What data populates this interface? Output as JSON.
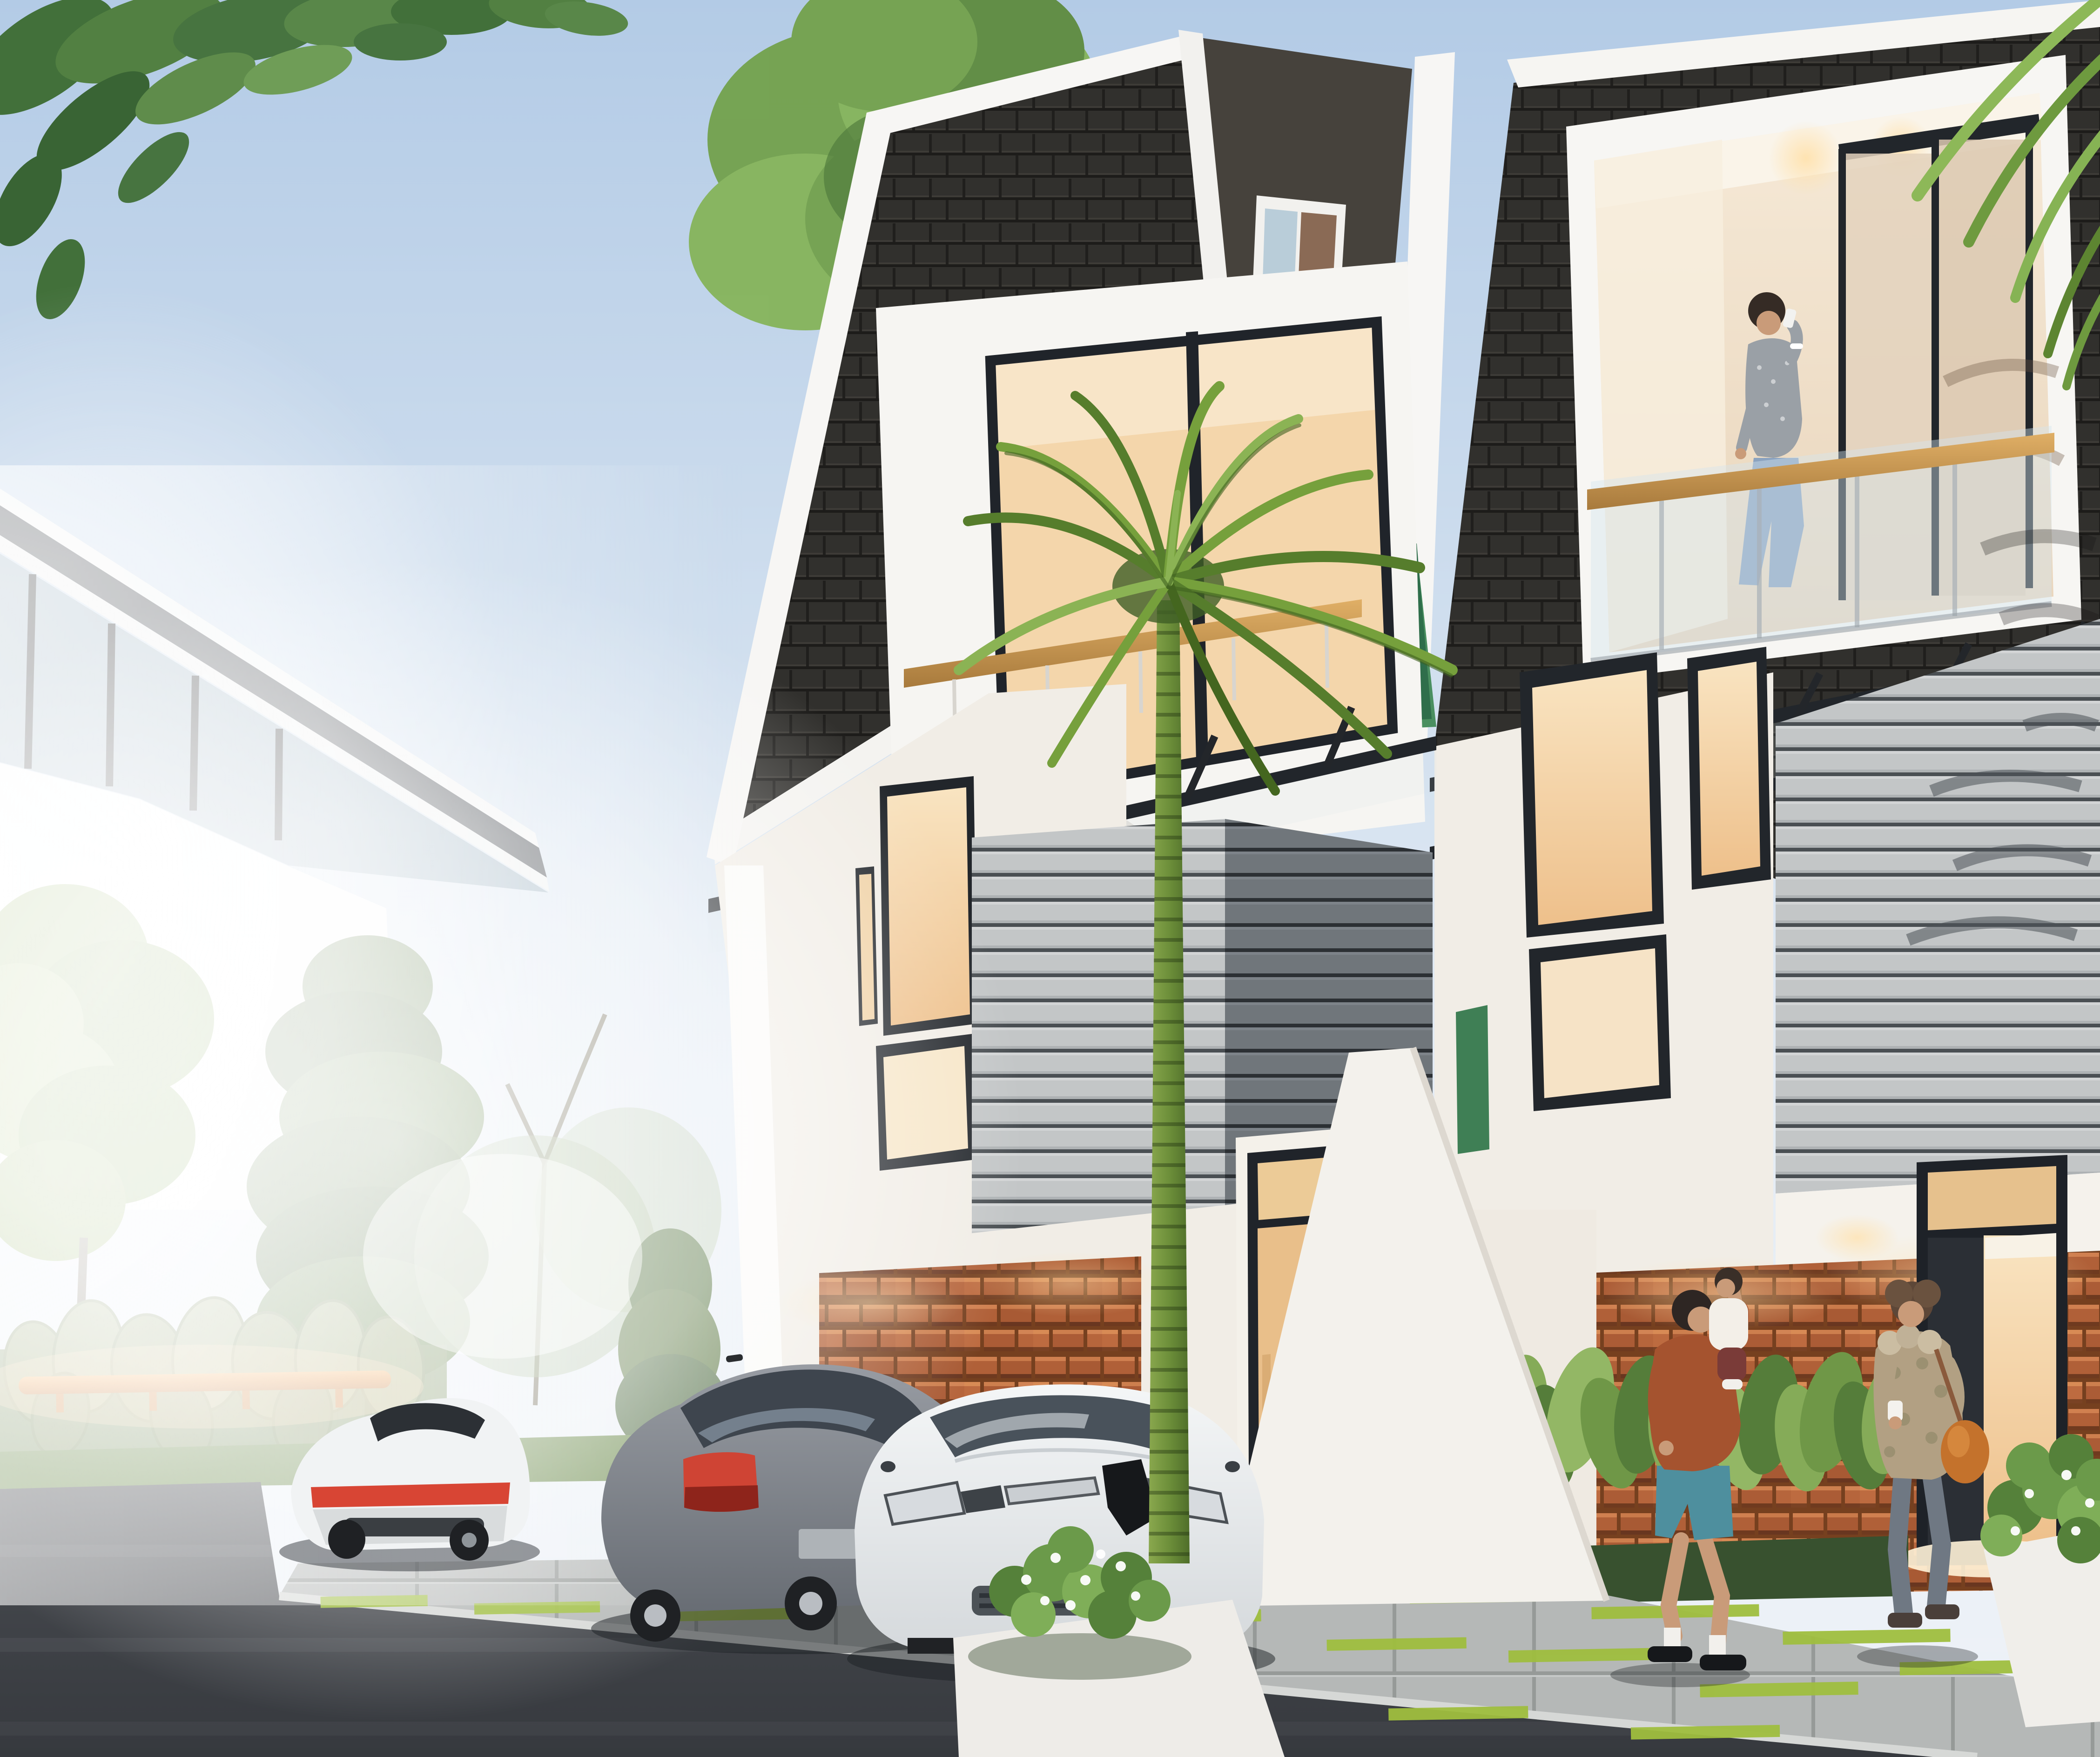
{
  "scene": {
    "description": "Dusk architectural rendering of two modern three-storey townhouses with black shingle roofs, white walls, a green accent wall and terracotta feature brick; warm lit windows, a tall slender palm in front, three cars parked on the paver drive, a woman on the upper balcony talking on a phone, a man carrying a child and a woman with a coffee cup and orange shoulder bag walking on the sidewalk, leafy trees, a white neighbouring house at left, hedge with an orange fence rail, pale blue sky with two birds",
    "objects": [
      {
        "name": "sky",
        "label": "pale blue dusk sky"
      },
      {
        "name": "birds",
        "label": "two birds flying"
      },
      {
        "name": "overhanging-branch",
        "label": "tree branch in top-left corner"
      },
      {
        "name": "neighbor-house",
        "label": "white neighbouring house with sloped dark fascia and clerestory windows"
      },
      {
        "name": "trees",
        "label": "deciduous tree, conifer and bare trees at left"
      },
      {
        "name": "hedge-orange-fence",
        "label": "agave hedge with orange fence rail"
      },
      {
        "name": "left-townhouse",
        "label": "left townhouse with shingle roof, white window box, wood rail, glass canopy, grey slat box, brick base, glass stair door"
      },
      {
        "name": "right-townhouse",
        "label": "right townhouse with roof balcony, glass railing, glass canopy, grey slat box, brick base, entry door"
      },
      {
        "name": "green-accent-wall",
        "label": "green feature wall between houses"
      },
      {
        "name": "palm-tree",
        "label": "tall slender palm in front of drive"
      },
      {
        "name": "white-coupe",
        "label": "white coupe parked at left, rear view"
      },
      {
        "name": "grey-sedan",
        "label": "grey sedan parked, rear three-quarter view"
      },
      {
        "name": "white-hatchback",
        "label": "white hatchback parked, front view"
      },
      {
        "name": "balcony-woman",
        "label": "woman on balcony talking on phone"
      },
      {
        "name": "man-with-child",
        "label": "man in rust shirt carrying a child"
      },
      {
        "name": "walking-woman",
        "label": "woman in tan jacket with coffee cup and orange bag"
      },
      {
        "name": "street",
        "label": "dark asphalt street"
      },
      {
        "name": "sidewalk",
        "label": "paver sidewalk and drive with lime grass joints"
      },
      {
        "name": "planters",
        "label": "white planters with flowering bushes"
      }
    ],
    "palette": {
      "sky_top": "#b3cbe6",
      "sky_mid": "#cfdeee",
      "sky_low": "#ecf1f7",
      "glare": "#ffffff",
      "roof": "#31302d",
      "trim_white": "#f6f5f2",
      "wall_white": "#f1ede6",
      "wall_shade": "#ddd6cc",
      "green_wall": "#4a8f60",
      "green_wall_dark": "#2f6e4b",
      "window_warm": "#f3cf9e",
      "window_warm_light": "#f9e4c1",
      "frame_dark": "#22262b",
      "siding_light": "#c3c6c7",
      "siding_dark": "#70767b",
      "brick": "#b06038",
      "brick_dark": "#7e4527",
      "brick_light": "#d88b55",
      "asphalt": "#45484d",
      "asphalt_dark": "#36393e",
      "paving": "#b5b8b7",
      "paving_gap": "#969a98",
      "curb": "#d6d8d6",
      "grass": "#6d8c4e",
      "lime": "#9fbe3e",
      "tree_green": "#79a650",
      "tree_dark": "#4b7338",
      "conifer": "#5f7d4a",
      "palm_green": "#76a03c",
      "palm_dark": "#55792b",
      "trunk": "#7c9b44",
      "glass_cool": "#9db3c2",
      "rail_wood": "#c8964e",
      "car_white": "#f1f3f4",
      "car_grey": "#85898f",
      "tail_red": "#d84534",
      "tire": "#1f2124",
      "skin": "#c99b79",
      "hair_dark": "#352b25",
      "shirt_rust": "#a5532f",
      "shorts_teal": "#4e8f9e",
      "jacket_tan": "#b2a083",
      "jeans": "#6f7883",
      "jeans_light": "#8ba3c0",
      "bag_orange": "#c4722c",
      "knit_grey": "#9aa0a6",
      "interior_cream": "#f0e2d0",
      "door_warm": "#e9c089",
      "fence_orange": "#d97f2e"
    }
  }
}
